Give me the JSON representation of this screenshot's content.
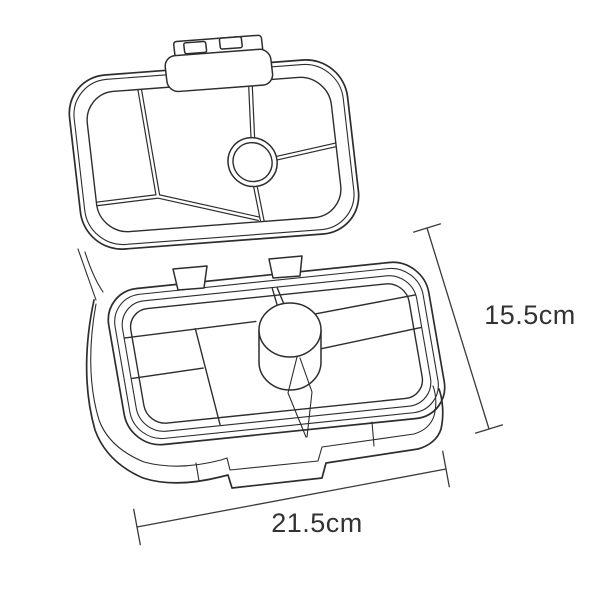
{
  "diagram": {
    "subject": "open bento lunchbox line drawing with lid compartments, tray compartments and round dip cup",
    "labels": {
      "height": "15.5cm",
      "width": "21.5cm"
    },
    "colors": {
      "line": "#2d2d2d",
      "text": "#333333",
      "background": "#ffffff"
    }
  }
}
